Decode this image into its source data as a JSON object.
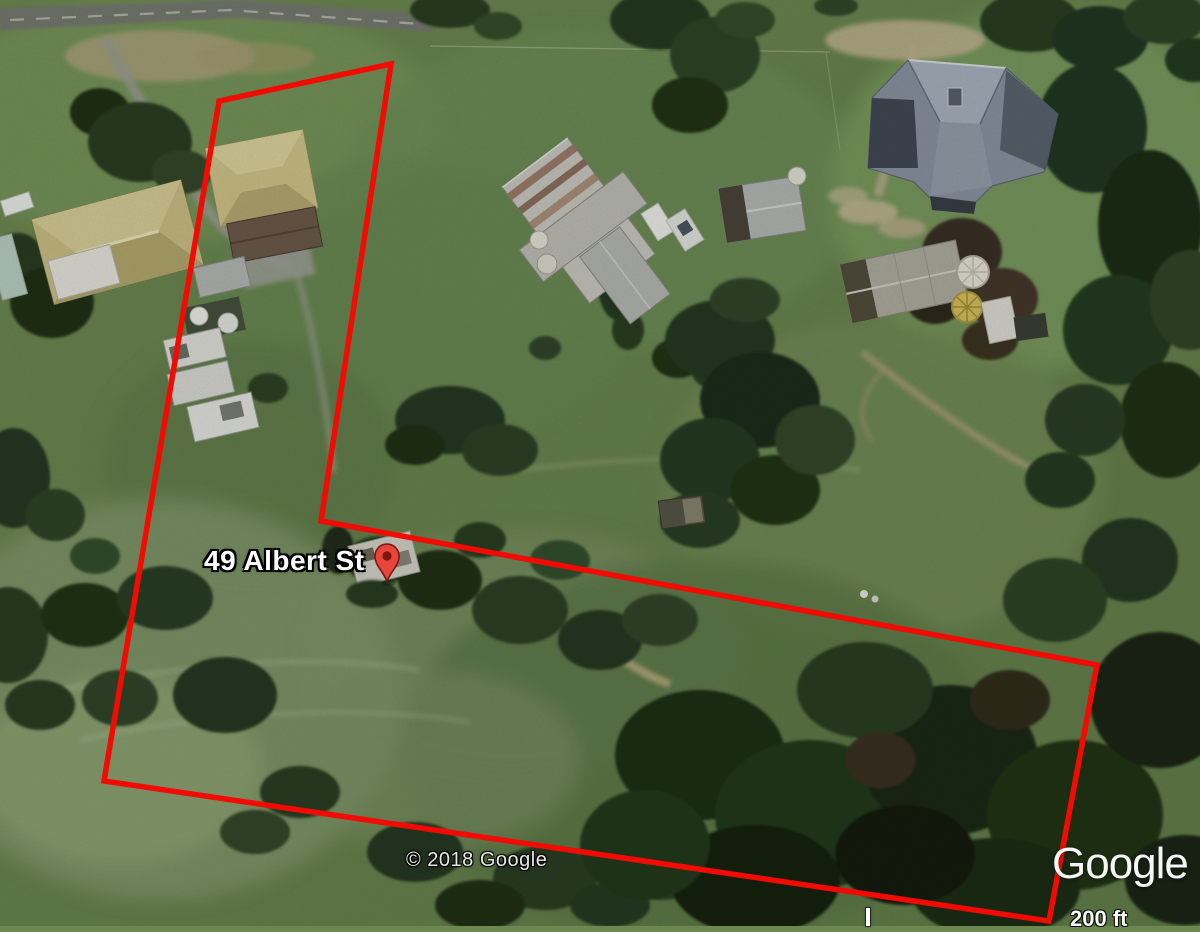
{
  "map": {
    "view": "satellite",
    "address_label": "49 Albert St",
    "attribution": "© 2018 Google",
    "watermark": "Google",
    "scale_bar": {
      "label": "200 ft"
    },
    "marker": {
      "icon": "location-pin-icon",
      "x": 387,
      "y": 582,
      "color": "#e8453c",
      "outline": "#7e150e",
      "hole_color": "#7e150e"
    },
    "boundary": {
      "color": "#f10b02",
      "stroke_width": 5.5,
      "points": [
        [
          391,
          64
        ],
        [
          219,
          101
        ],
        [
          104,
          781
        ],
        [
          1049,
          921
        ],
        [
          1097,
          665
        ],
        [
          321,
          521
        ]
      ]
    }
  }
}
